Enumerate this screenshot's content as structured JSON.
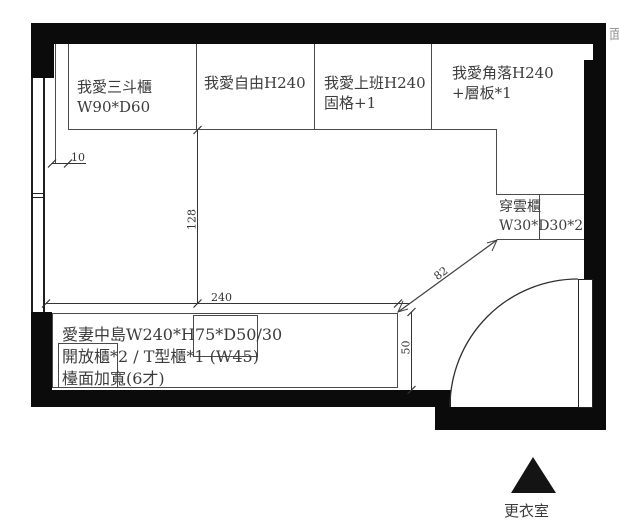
{
  "plan": {
    "cabinets": [
      {
        "lines": [
          "我愛三斗櫃",
          "W90*D60"
        ]
      },
      {
        "lines": [
          "我愛自由H240"
        ]
      },
      {
        "lines": [
          "我愛上班H240",
          "固格+1"
        ]
      },
      {
        "lines": [
          "我愛角落H240",
          "+層板*1"
        ]
      },
      {
        "lines": [
          "穿雲櫃",
          "W30*D30*2"
        ]
      }
    ],
    "island": {
      "lines": [
        "愛妻中島W240*H75*D50/30",
        "開放櫃*2 / T型櫃*1 (W45)",
        "檯面加寬(6才)"
      ]
    },
    "dimensions": {
      "offset": "10",
      "clearance": "128",
      "island_width": "240",
      "island_depth": "50",
      "diagonal": "82"
    },
    "room_label": "更衣室",
    "edge_glyph": "面"
  },
  "colors": {
    "wall": "#0b0b0b",
    "line": "#4b4b4b",
    "dimension": "#343434",
    "text": "#3c3c3c"
  }
}
